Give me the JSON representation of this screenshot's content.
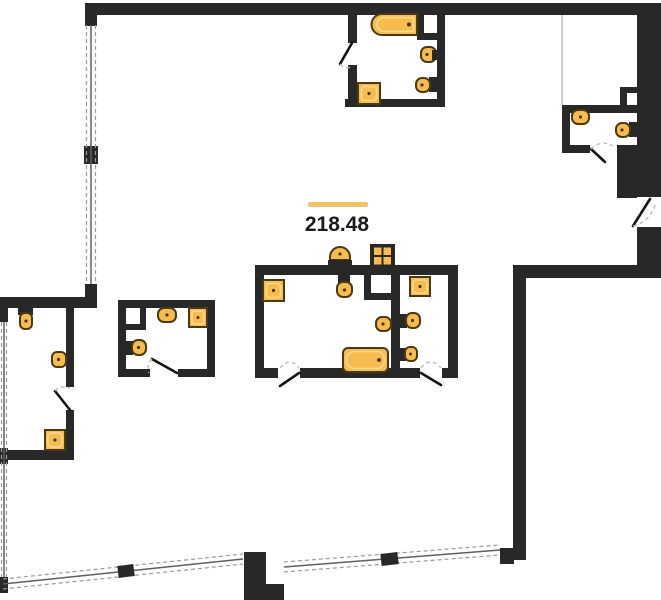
{
  "floorplan": {
    "area_label": "218.48",
    "colors": {
      "wall": "#282828",
      "background": "#ffffff",
      "fixture": "#F7BC4D",
      "fixture_inner": "#FBDA94",
      "fixture_border": "#4a3a14",
      "accent_line": "#EFC36B",
      "text": "#1b1b1b",
      "window_solid": "#606060",
      "window_dash": "#9a9a9a",
      "door_leaf": "#141414",
      "door_arc": "#b9b9b9",
      "thin_partition": "#cfcfcf"
    },
    "fixtures": [
      "bathtub",
      "bathtub",
      "shower-tray",
      "shower-tray",
      "shower-tray",
      "shower-tray",
      "washbasin",
      "washbasin",
      "washbasin",
      "washbasin",
      "washbasin",
      "washbasin",
      "toilet",
      "toilet",
      "toilet",
      "toilet",
      "toilet",
      "kitchen-sink",
      "kitchen-stove"
    ]
  }
}
